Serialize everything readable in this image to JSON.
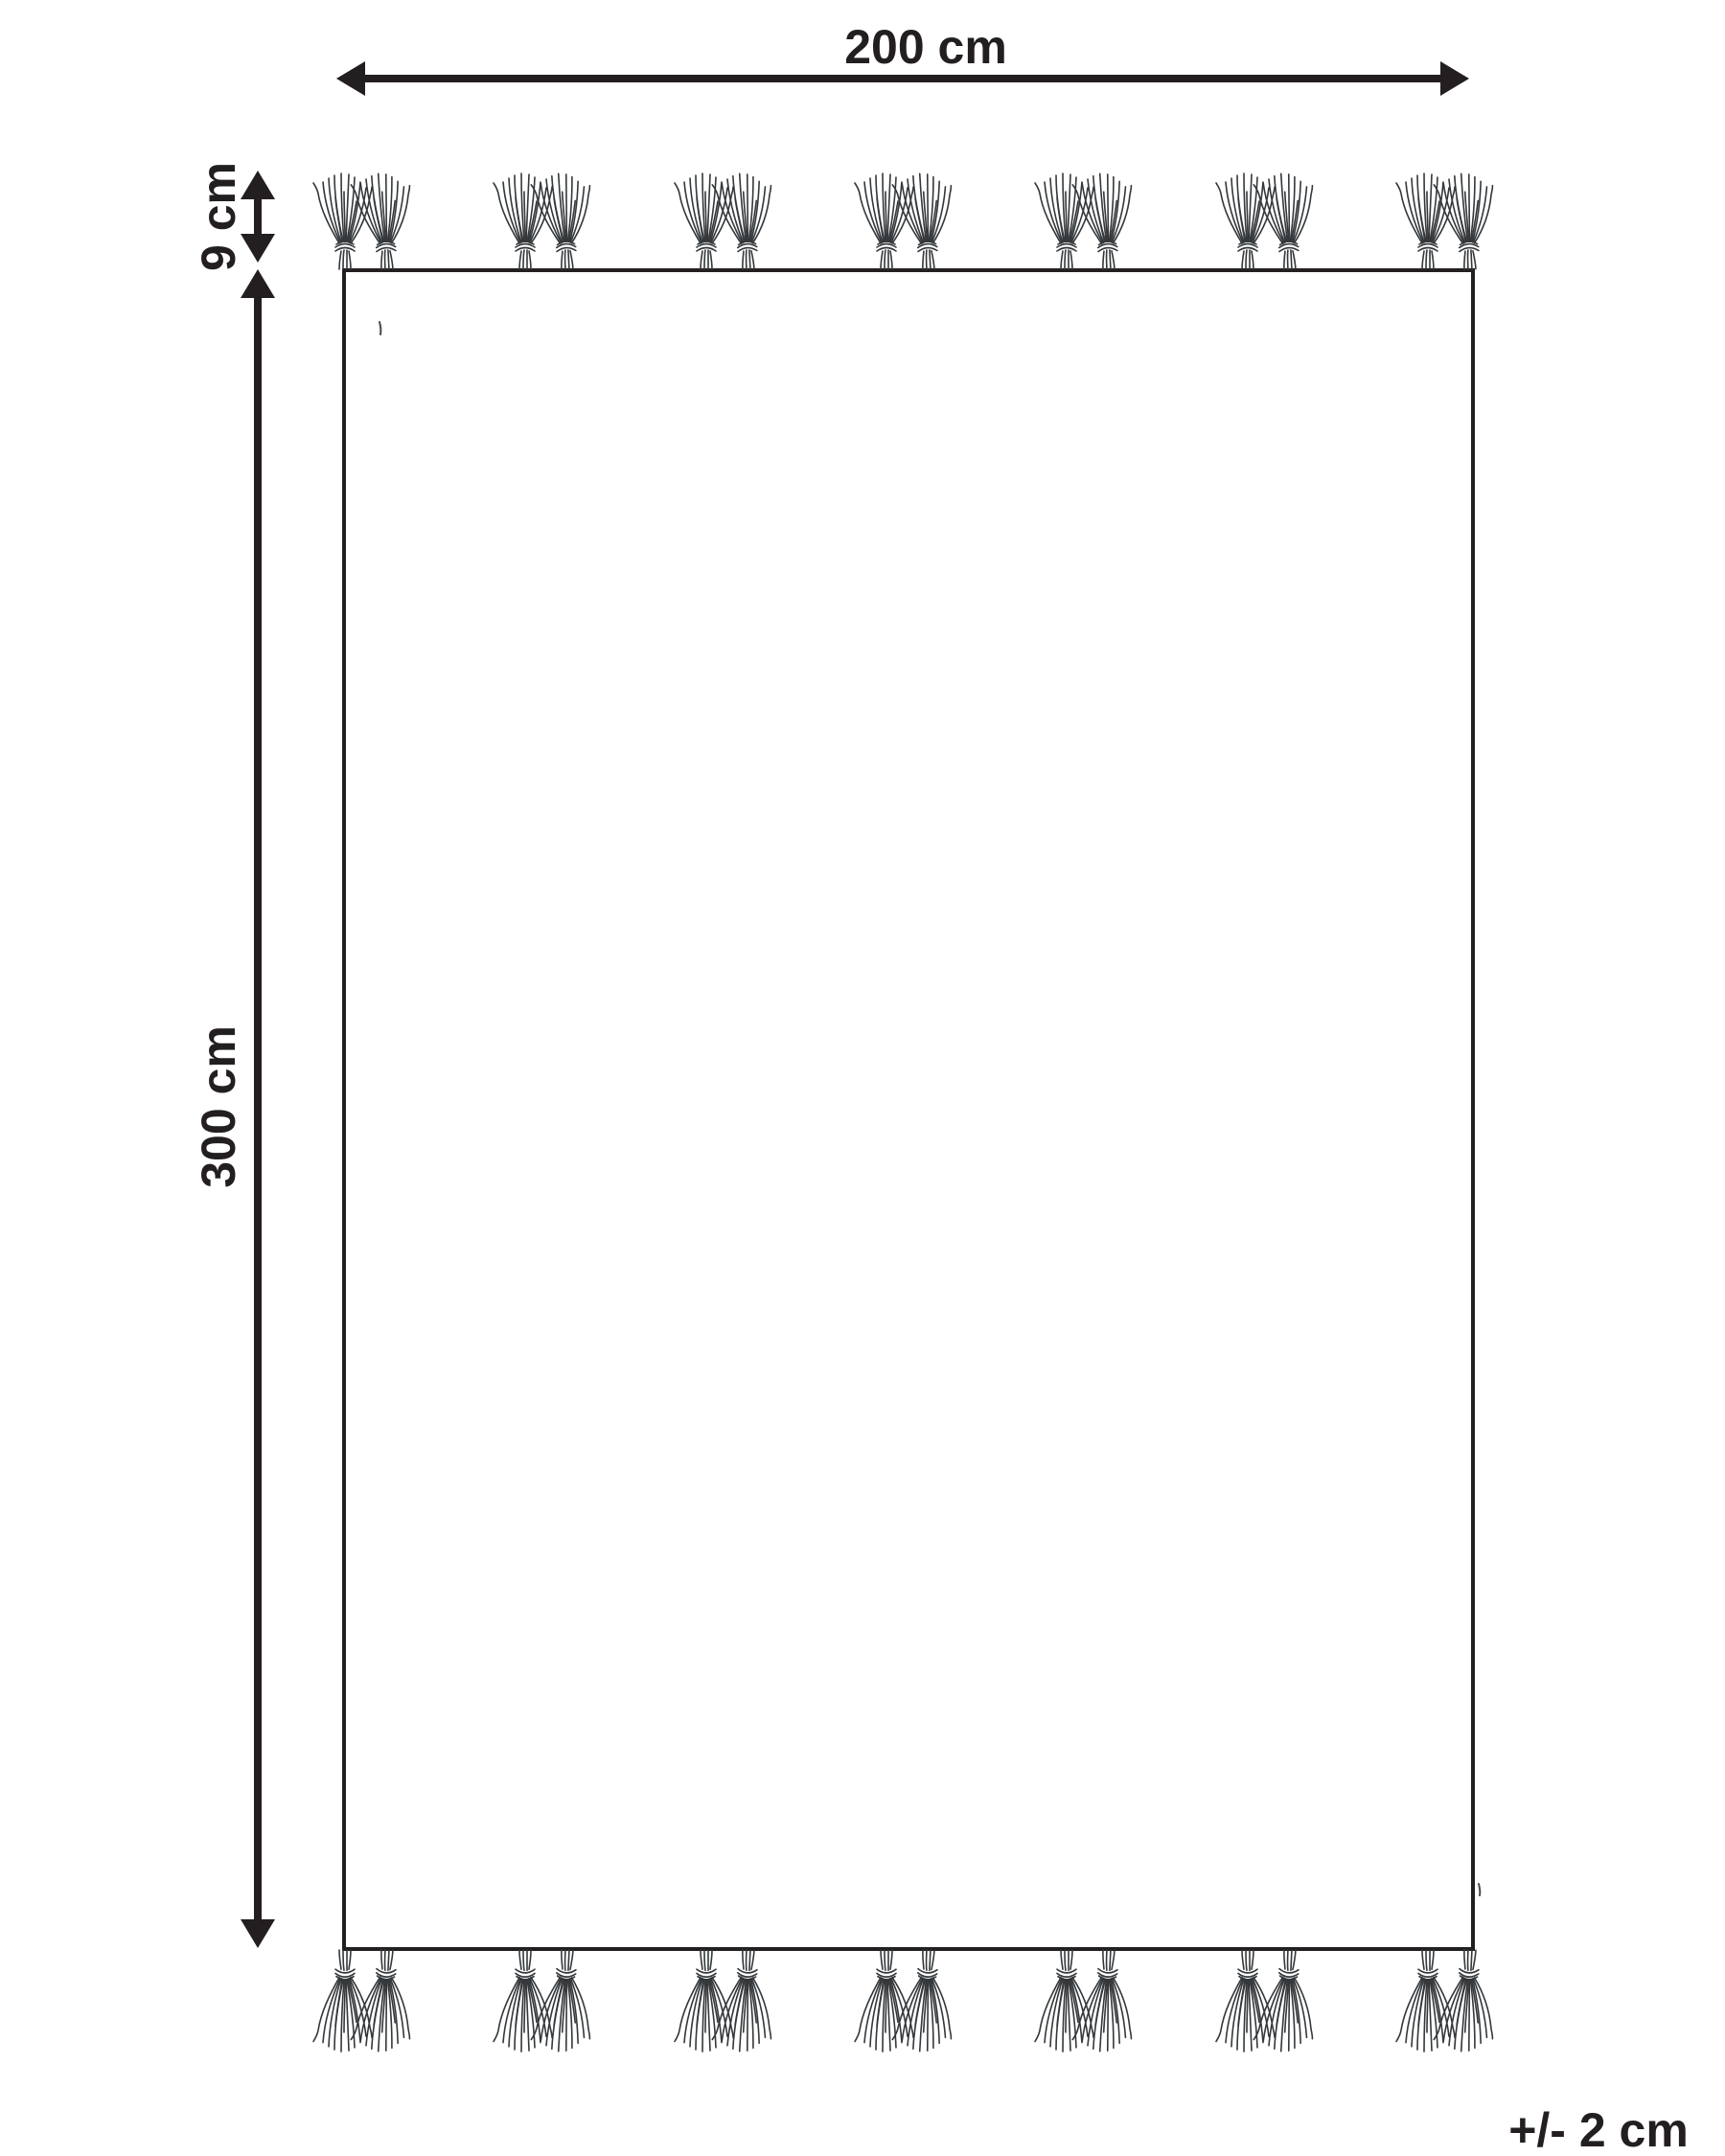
{
  "figure": {
    "dimensions": {
      "width_label": "200 cm",
      "height_label": "300 cm",
      "fringe_label": "9 cm",
      "tolerance_label": "+/- 2 cm"
    },
    "fringe": {
      "edges_with_fringe": "top and bottom",
      "clusters_per_edge": 7,
      "tassels_per_cluster": 2
    },
    "colors": {
      "ink": "#231f20",
      "strand_ink": "#34383b",
      "background": "#ffffff"
    }
  }
}
